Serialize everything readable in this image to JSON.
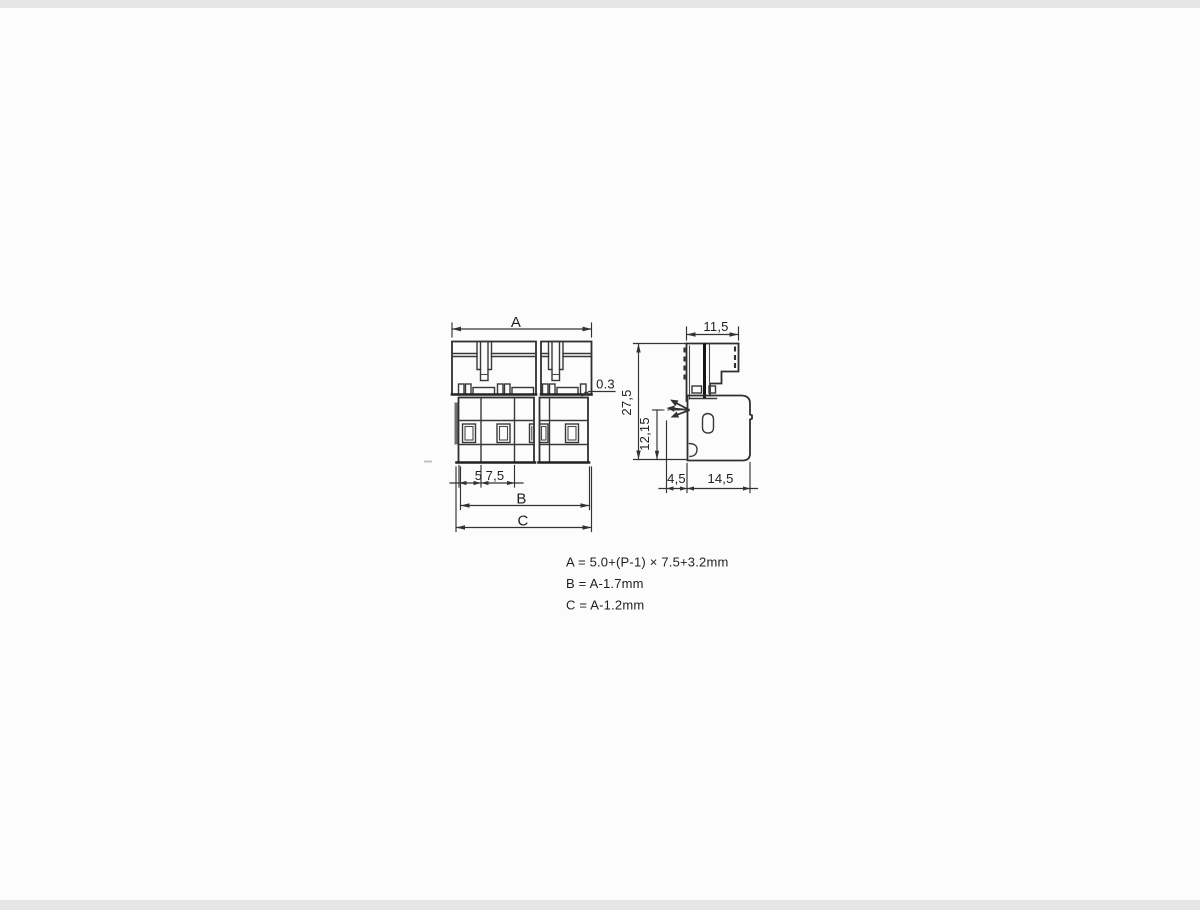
{
  "front_view": {
    "dims": {
      "overall_width": "A",
      "body_width": "B",
      "outer_width": "C",
      "step": "0.3",
      "first_pitch": "5",
      "pole_pitch": "7,5"
    }
  },
  "side_view": {
    "dims": {
      "top_width": "11,5",
      "overall_height": "27,5",
      "lower_height": "12,15",
      "front_depth": "4,5",
      "body_depth": "14,5"
    }
  },
  "formulas": {
    "line1": "A = 5.0+(P-1) × 7.5+3.2mm",
    "line2": "B = A-1.7mm",
    "line3": "C = A-1.2mm"
  },
  "colors": {
    "background": "#fcfcfc",
    "line": "#383838",
    "edge_band": "#e6e6e6"
  }
}
